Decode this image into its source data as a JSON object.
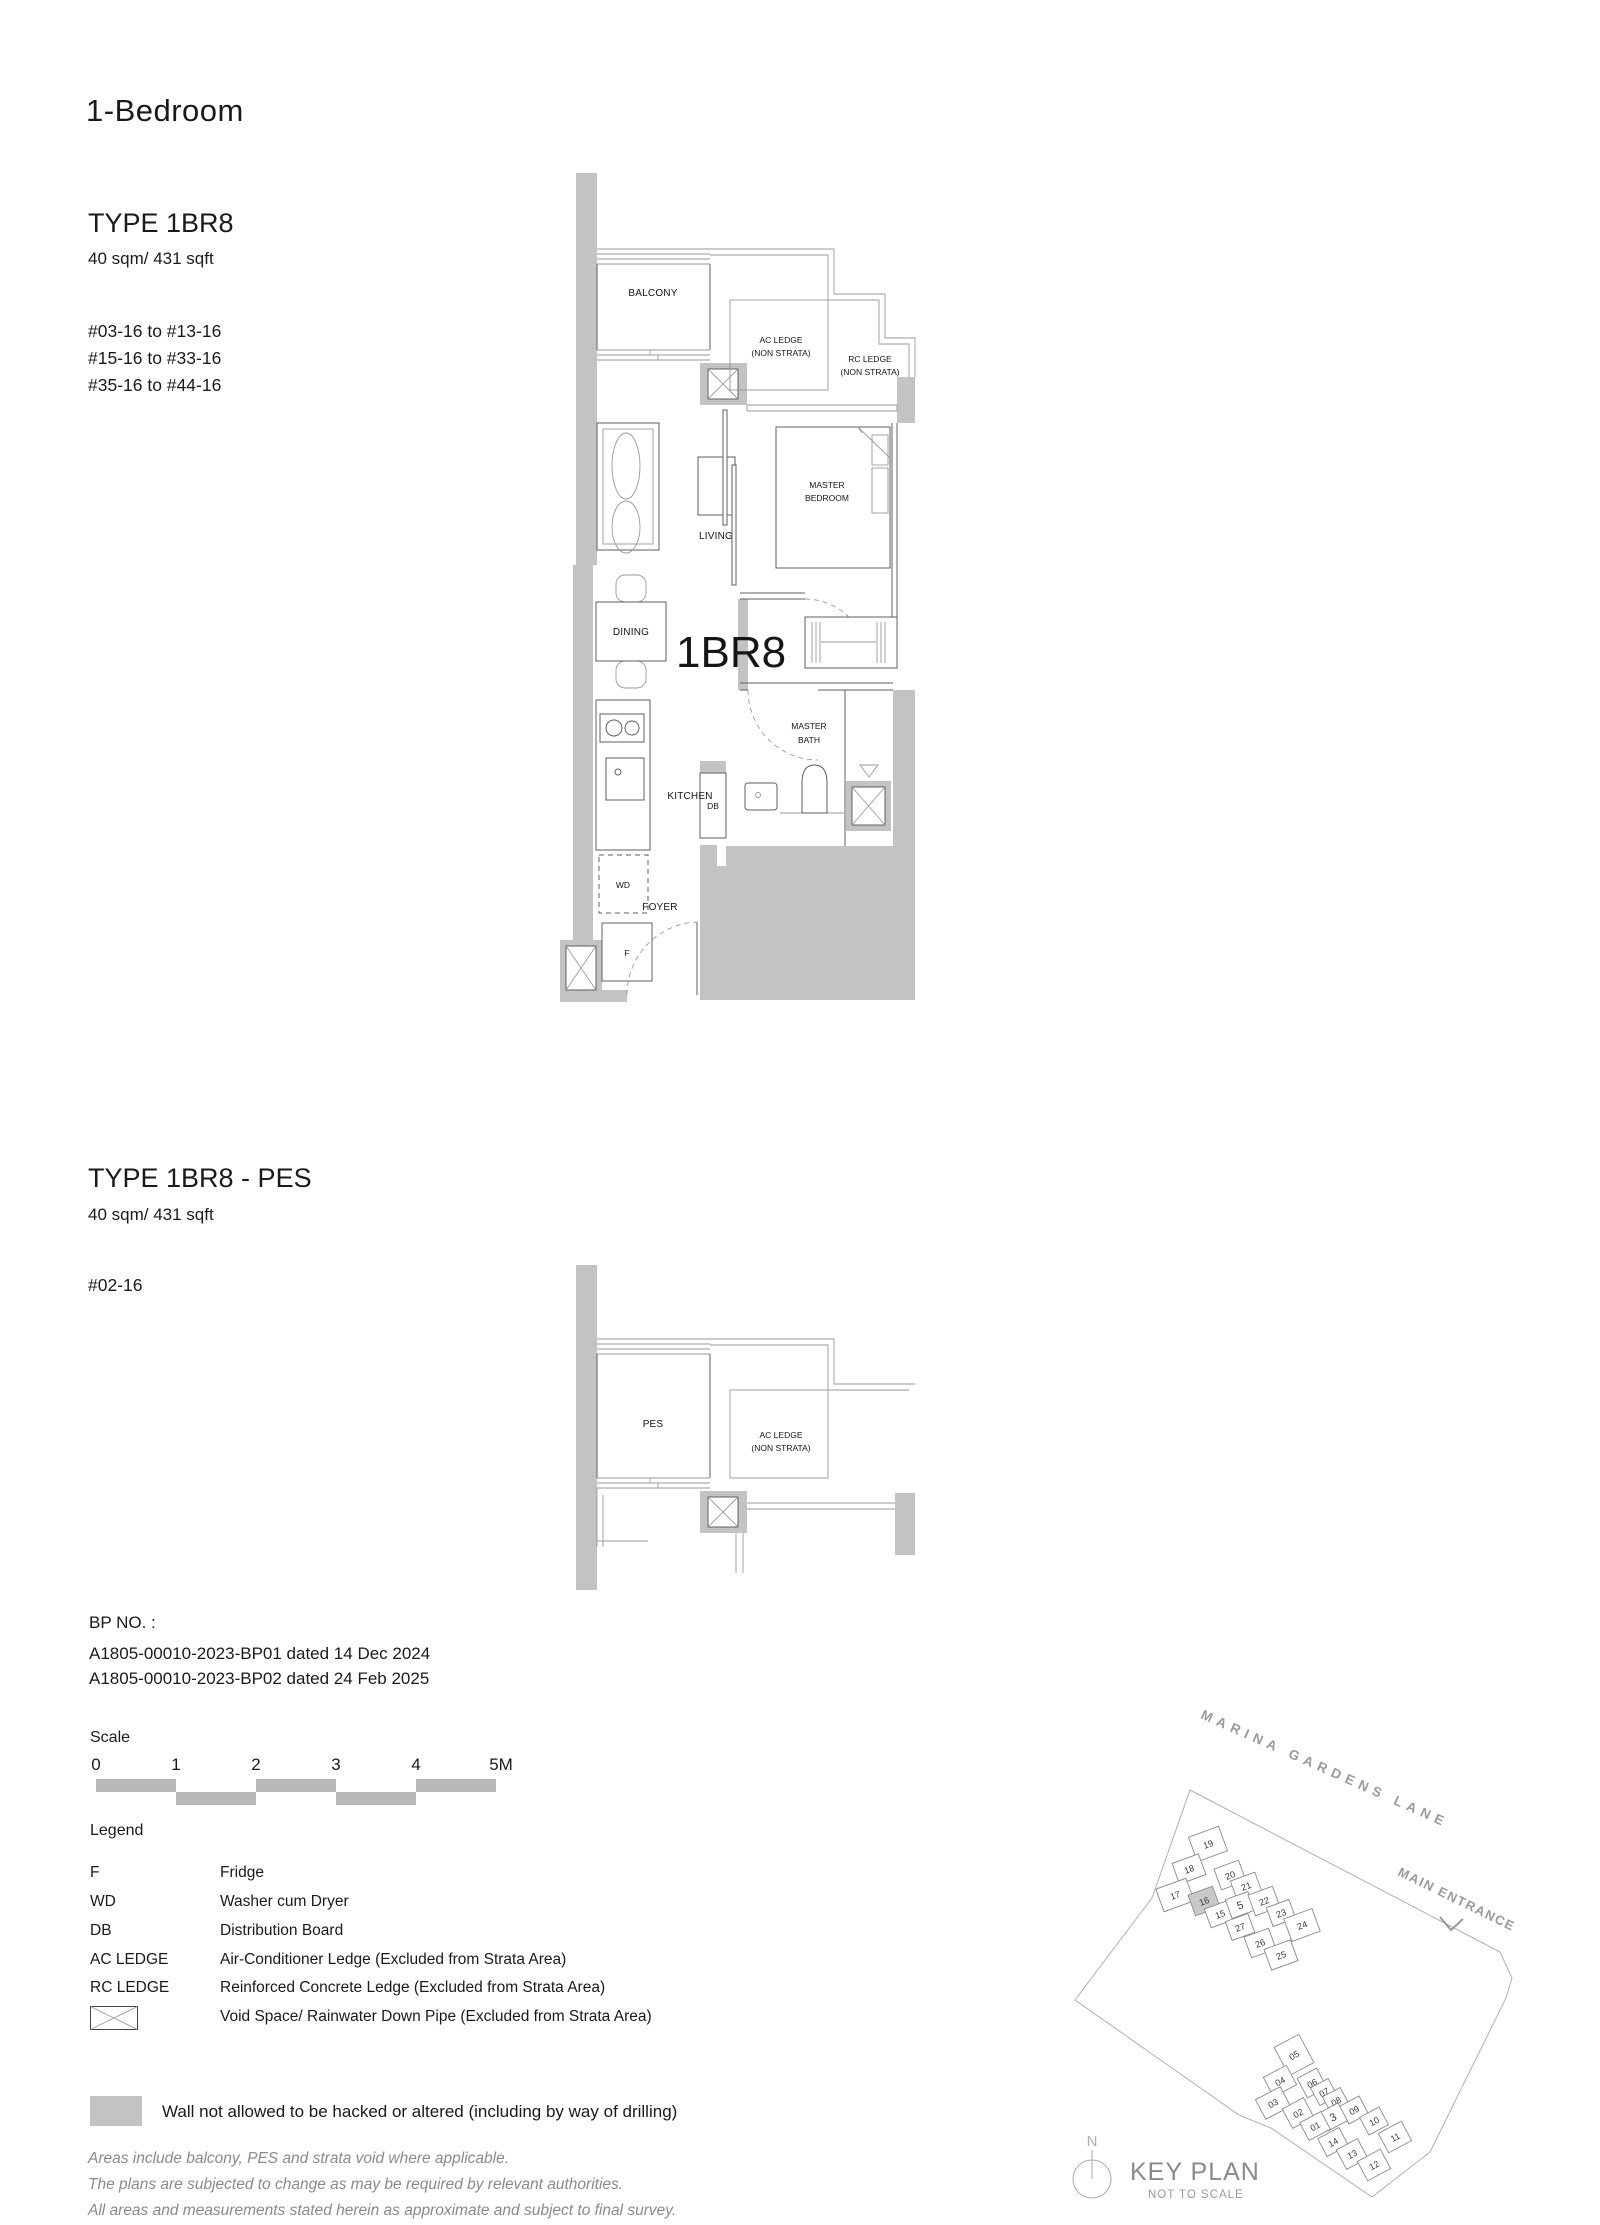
{
  "page": {
    "title": "1-Bedroom"
  },
  "type1": {
    "name": "TYPE 1BR8",
    "area": "40 sqm/ 431 sqft",
    "stacks": [
      "#03-16 to #13-16",
      "#15-16 to #33-16",
      "#35-16 to #44-16"
    ]
  },
  "type2": {
    "name": "TYPE 1BR8 - PES",
    "area": "40 sqm/ 431 sqft",
    "stacks": [
      "#02-16"
    ]
  },
  "plan": {
    "unit_label": "1BR8",
    "balcony": "BALCONY",
    "pes": "PES",
    "ac_ledge_1": "AC LEDGE",
    "ac_ledge_2": "(NON STRATA)",
    "rc_ledge_1": "RC LEDGE",
    "rc_ledge_2": "(NON STRATA)",
    "living": "LIVING",
    "dining": "DINING",
    "master_bedroom_1": "MASTER",
    "master_bedroom_2": "BEDROOM",
    "master_bath_1": "MASTER",
    "master_bath_2": "BATH",
    "kitchen": "KITCHEN",
    "foyer": "FOYER",
    "db": "DB",
    "wd": "WD",
    "fridge": "F"
  },
  "bp": {
    "label": "BP NO. :",
    "lines": [
      "A1805-00010-2023-BP01 dated 14 Dec 2024",
      "A1805-00010-2023-BP02 dated 24 Feb 2025"
    ]
  },
  "scalebar": {
    "label": "Scale",
    "ticks": [
      "0",
      "1",
      "2",
      "3",
      "4",
      "5M"
    ]
  },
  "legend": {
    "title": "Legend",
    "items": [
      [
        "F",
        "Fridge"
      ],
      [
        "WD",
        "Washer cum Dryer"
      ],
      [
        "DB",
        "Distribution Board"
      ],
      [
        "AC LEDGE",
        "Air-Conditioner Ledge (Excluded from Strata Area)"
      ],
      [
        "RC LEDGE",
        "Reinforced Concrete Ledge (Excluded from Strata Area)"
      ]
    ],
    "void_desc": "Void Space/ Rainwater Down Pipe (Excluded from Strata Area)"
  },
  "wall_note": "Wall not allowed to be hacked or altered (including by way of drilling)",
  "disclaimer": [
    "Areas include balcony, PES and strata void where applicable.",
    "The plans are subjected to change as may be required by relevant authorities.",
    "All areas and measurements stated herein as approximate and subject to final survey."
  ],
  "keyplan": {
    "road": "MARINA GARDENS LANE",
    "entrance": "MAIN ENTRANCE",
    "title": "KEY PLAN",
    "subtitle": "NOT TO SCALE",
    "north": "N",
    "highlighted_unit": "16",
    "cluster1": [
      "19",
      "18",
      "17",
      "20",
      "21",
      "16",
      "15",
      "5",
      "22",
      "23",
      "24",
      "27",
      "26",
      "25"
    ],
    "cluster2": [
      "05",
      "04",
      "03",
      "06",
      "07",
      "08",
      "09",
      "3",
      "02",
      "01",
      "14",
      "10",
      "11",
      "13",
      "12"
    ]
  },
  "colors": {
    "wall": "#c3c3c3",
    "scalebar": "#b9b9b9",
    "muted_text": "#8a8a8a"
  }
}
